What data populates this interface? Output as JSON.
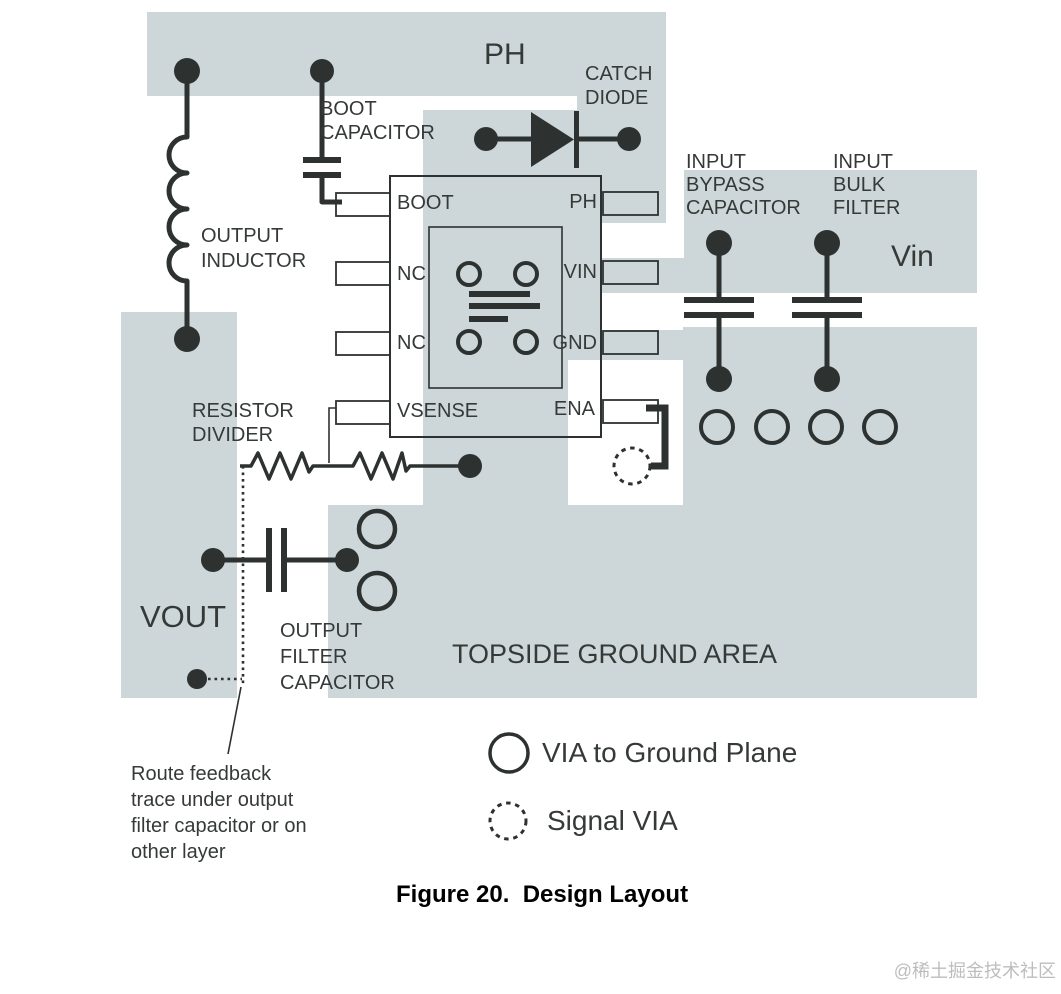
{
  "figure": {
    "caption": "Figure 20.  Design Layout",
    "watermark": "@稀土掘金技术社区"
  },
  "colors": {
    "copper_area": "#cdd7d9",
    "line": "#2d3231",
    "text": "#353a39",
    "watermark": "#bdbdbd"
  },
  "labels": {
    "ph_node": "PH",
    "vin_node": "Vin",
    "vout_node": "VOUT",
    "topside_ground_area": "TOPSIDE GROUND AREA",
    "catch_diode": [
      "CATCH",
      "DIODE"
    ],
    "boot_capacitor": [
      "BOOT",
      "CAPACITOR"
    ],
    "output_inductor": [
      "OUTPUT",
      "INDUCTOR"
    ],
    "resistor_divider": [
      "RESISTOR",
      "DIVIDER"
    ],
    "output_filter_capacitor": [
      "OUTPUT",
      "FILTER",
      "CAPACITOR"
    ],
    "input_bypass_capacitor": [
      "INPUT",
      "BYPASS",
      "CAPACITOR"
    ],
    "input_bulk_filter": [
      "INPUT",
      "BULK",
      "FILTER"
    ]
  },
  "ic": {
    "left_pins": [
      "BOOT",
      "NC",
      "NC",
      "VSENSE"
    ],
    "right_pins": [
      "PH",
      "VIN",
      "GND",
      "ENA"
    ]
  },
  "legend": {
    "ground_via_label": "VIA to Ground Plane",
    "signal_via_label": "Signal VIA"
  },
  "notes": {
    "route_feedback": [
      "Route feedback",
      "trace under output",
      "filter capacitor or on",
      "other layer"
    ]
  }
}
